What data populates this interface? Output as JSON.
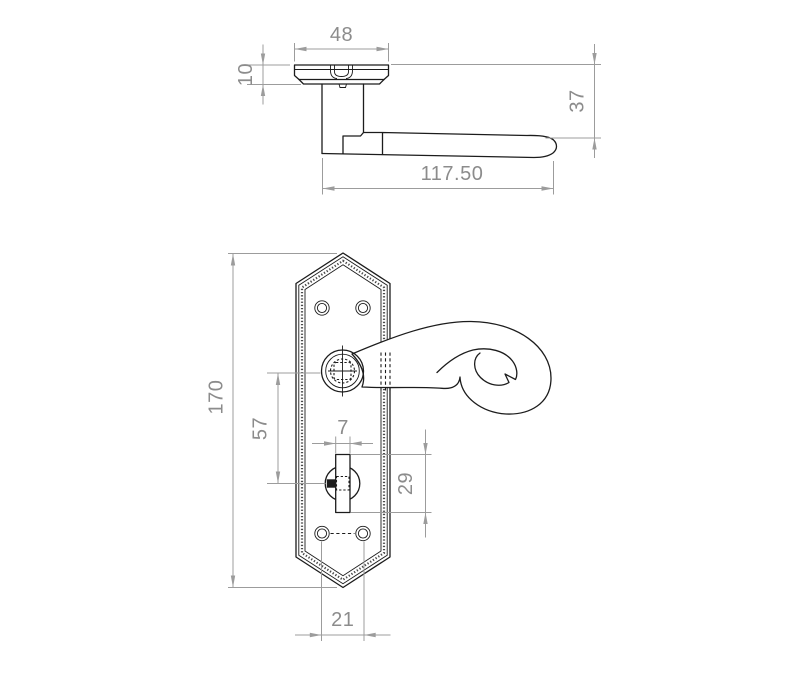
{
  "drawing": {
    "type": "technical-dimension-drawing",
    "subject": "monkey-tail lever door handle on pointed backplate with bathroom thumbturn, side view and front view",
    "colors": {
      "object_line": "#1c1c1c",
      "dimension_line": "#9c9c9c",
      "dimension_text": "#8c8c8c",
      "background": "#ffffff"
    },
    "side_view": {
      "dim_rose_width": "48",
      "dim_rose_depth": "10",
      "dim_projection": "37",
      "dim_overall_length": "117.50"
    },
    "front_view": {
      "dim_plate_height": "170",
      "dim_lever_to_turn_centres": "57",
      "dim_turn_width": "7",
      "dim_turn_height": "29",
      "dim_screw_hole_spacing": "21"
    }
  }
}
